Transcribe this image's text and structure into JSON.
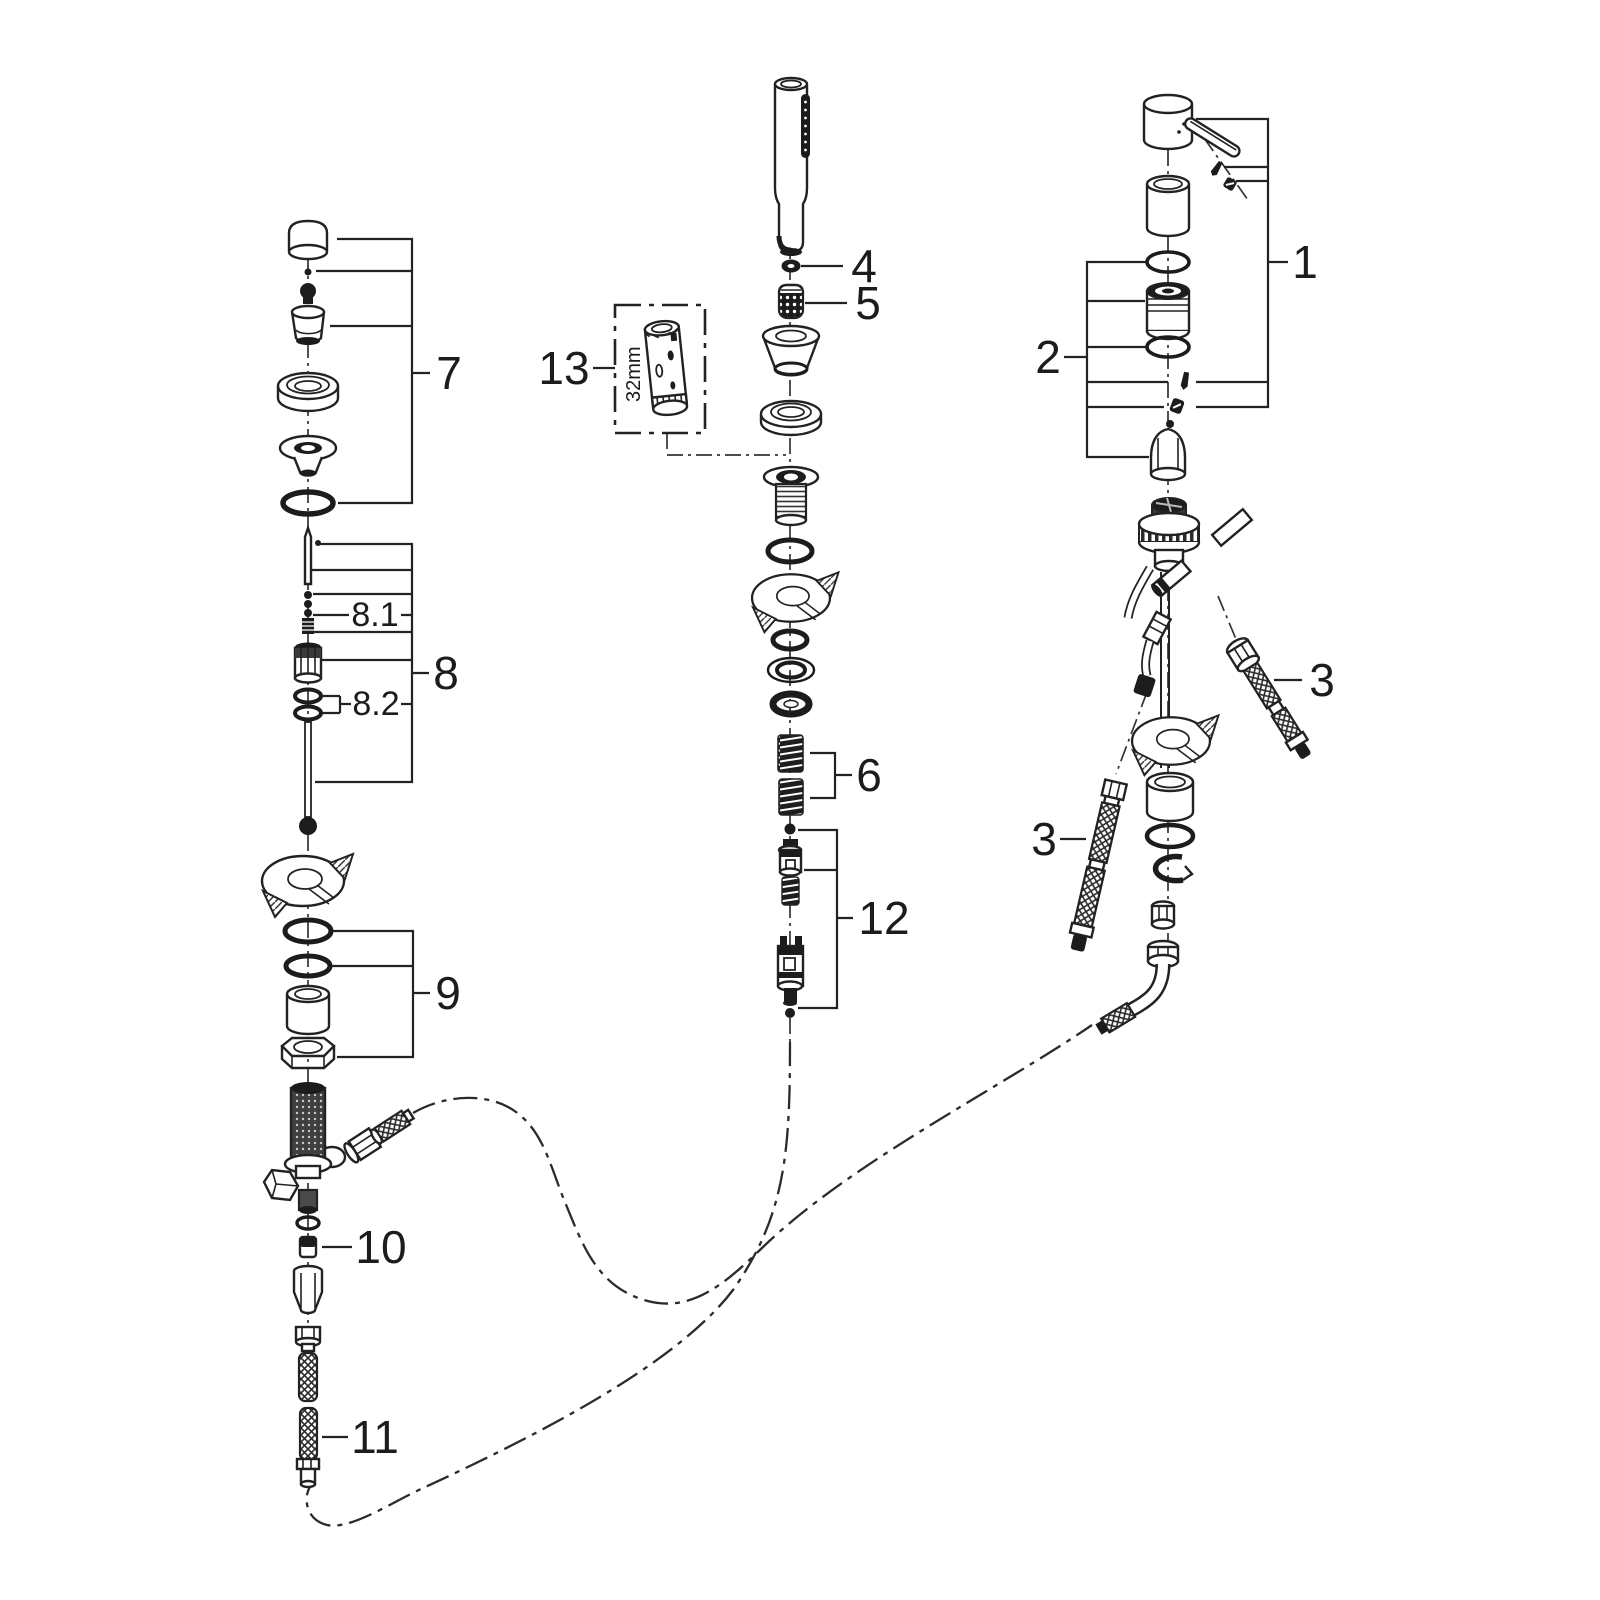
{
  "diagram": {
    "kind": "exploded-parts-diagram",
    "callouts": {
      "c1": {
        "label": "1"
      },
      "c2": {
        "label": "2"
      },
      "c3_right": {
        "label": "3"
      },
      "c3_left": {
        "label": "3"
      },
      "c4": {
        "label": "4"
      },
      "c5": {
        "label": "5"
      },
      "c6": {
        "label": "6"
      },
      "c7": {
        "label": "7"
      },
      "c8": {
        "label": "8"
      },
      "c8_1": {
        "label": "8.1"
      },
      "c8_2": {
        "label": "8.2"
      },
      "c9": {
        "label": "9"
      },
      "c10": {
        "label": "10"
      },
      "c11": {
        "label": "11"
      },
      "c12": {
        "label": "12"
      },
      "c13": {
        "label": "13"
      },
      "tool_size": {
        "label": "32mm"
      }
    }
  }
}
